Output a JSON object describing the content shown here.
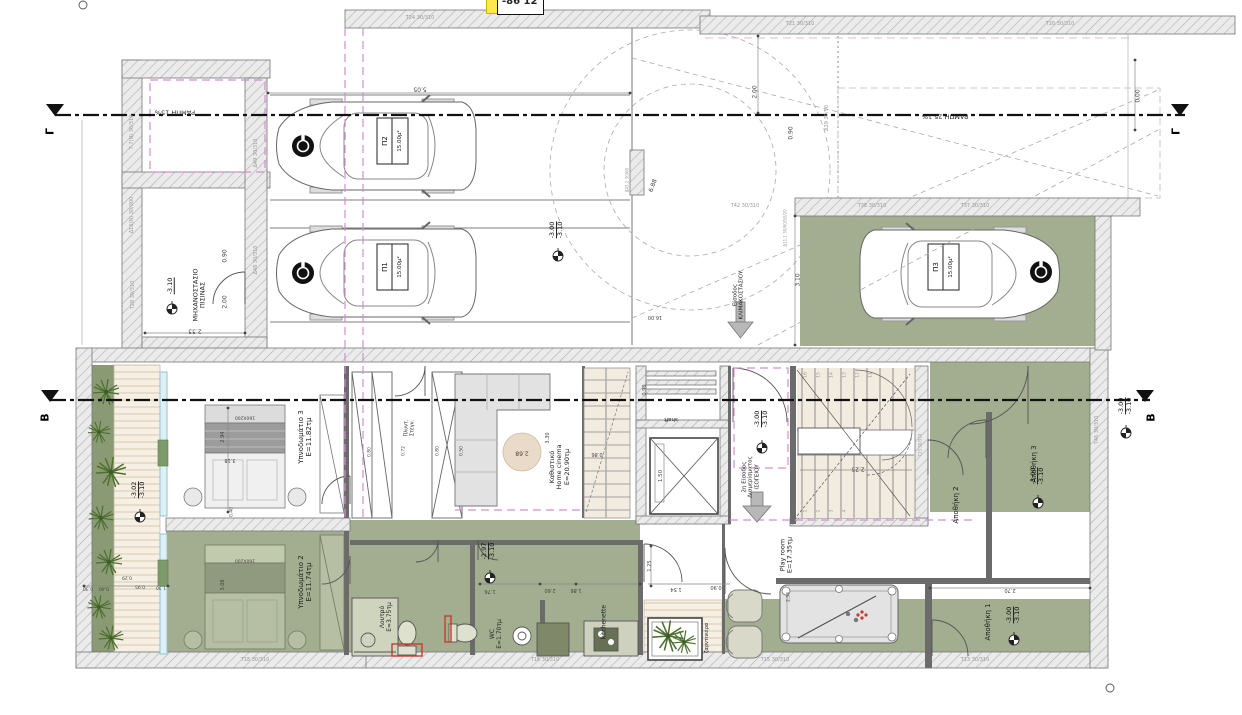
{
  "corner_tag": {
    "text": "-86 12"
  },
  "colors": {
    "zone_green": "#a3ad90",
    "planter_green": "#8a9a74",
    "magenta_dash": "#cf8fcf",
    "stair_beige": "#f2ebe0",
    "highlight_yellow": "#ffe84d",
    "alert_red": "#c53c2e"
  },
  "section_markers": [
    {
      "text": "Γ",
      "x": 51,
      "y": 131
    },
    {
      "text": "Γ",
      "x": 1177,
      "y": 131
    },
    {
      "text": "B",
      "x": 46,
      "y": 417
    },
    {
      "text": "B",
      "x": 1152,
      "y": 417
    }
  ],
  "ramp_labels": [
    {
      "text": "ΡΑΜΠΗ 15%",
      "x": 175,
      "y": 112
    },
    {
      "text": "ΡΑΜΠΗ 25.1%",
      "x": 945,
      "y": 116
    }
  ],
  "rooms": [
    {
      "n": "room-label-pool-plant-room",
      "lines": [
        "ΜΗΧΑΝΟΣΤΑΣΙΟ",
        "ΠΙΣΙΝΑΣ"
      ],
      "x": 200,
      "y": 295,
      "size": 6.5
    },
    {
      "n": "room-label-bedroom-3",
      "lines": [
        "Υπνοδωμάτιο 3",
        "E=11.82τμ"
      ],
      "x": 305,
      "y": 437
    },
    {
      "n": "room-label-bedroom-2",
      "lines": [
        "Υπνοδωμάτιο 2",
        "E=11.74τμ"
      ],
      "x": 305,
      "y": 582
    },
    {
      "n": "room-label-living",
      "lines": [
        "Καθιστικό",
        "Home cinema",
        "E=20.90τμ"
      ],
      "x": 560,
      "y": 467,
      "size": 6.5
    },
    {
      "n": "room-label-bath",
      "lines": [
        "Λουτρό",
        "E=3.75τμ"
      ],
      "x": 387,
      "y": 617,
      "size": 6
    },
    {
      "n": "room-label-wc",
      "lines": [
        "WC",
        "E=1.70τμ"
      ],
      "x": 497,
      "y": 634,
      "size": 6
    },
    {
      "n": "room-label-kitchenette",
      "lines": [
        "kitchenette"
      ],
      "x": 605,
      "y": 622,
      "size": 6
    },
    {
      "n": "room-label-playroom",
      "lines": [
        "Play room",
        "E=17.35τμ"
      ],
      "x": 787,
      "y": 555,
      "size": 6.5
    },
    {
      "n": "room-label-storage-2",
      "lines": [
        "Αποθήκη 2"
      ],
      "x": 956,
      "y": 505
    },
    {
      "n": "room-label-storage-3",
      "lines": [
        "Αποθήκη 3"
      ],
      "x": 1034,
      "y": 464
    },
    {
      "n": "room-label-storage-1",
      "lines": [
        "Αποθήκη 1"
      ],
      "x": 988,
      "y": 622
    },
    {
      "n": "room-label-2nd-entrance",
      "lines": [
        "2η Είσοδος",
        "Διαμερίσματος",
        "ΙΣΟΓΕΙΟΥ"
      ],
      "x": 751,
      "y": 477,
      "size": 5.5
    },
    {
      "n": "room-label-shaft",
      "lines": [
        "shaft"
      ],
      "x": 671,
      "y": 419,
      "rot": 180,
      "size": 5.5
    },
    {
      "n": "room-label-planter",
      "lines": [
        "ζαρντινιέρα"
      ],
      "x": 708,
      "y": 638,
      "size": 5
    },
    {
      "n": "room-label-laundry",
      "lines": [
        "Πλυντ.",
        "Στεγν."
      ],
      "x": 410,
      "y": 428,
      "size": 5
    },
    {
      "n": "room-label-stair-entrance",
      "lines": [
        "Είσοδος",
        "ΚΛΙΜΑΚΟΣΤΑΣΙΟΥ"
      ],
      "x": 739,
      "y": 295,
      "size": 5.5
    }
  ],
  "parking": [
    {
      "n": "parking-space-p2",
      "id": "Π2",
      "area": "15.00μ²",
      "idx": 385,
      "idy": 141,
      "arx": 400,
      "ary": 141
    },
    {
      "n": "parking-space-p1",
      "id": "Π1",
      "area": "15.00μ²",
      "idx": 385,
      "idy": 267,
      "arx": 400,
      "ary": 267
    },
    {
      "n": "parking-space-p3",
      "id": "Π3",
      "area": "15.00μ²",
      "idx": 936,
      "idy": 267,
      "arx": 951,
      "ary": 267
    }
  ],
  "levels": [
    {
      "n": "level-mech-room",
      "top": "-3.10",
      "x": 171,
      "y": 286,
      "single": true
    },
    {
      "n": "level-garage",
      "top": "-3.00",
      "bottom": "-3.10",
      "x": 557,
      "y": 230
    },
    {
      "n": "level-entry-hall",
      "top": "-3.00",
      "bottom": "-3.10",
      "x": 762,
      "y": 419
    },
    {
      "n": "level-storage-3",
      "top": "-3.00",
      "bottom": "-3.10",
      "x": 1038,
      "y": 476
    },
    {
      "n": "level-storage-1",
      "top": "-3.00",
      "bottom": "-3.10",
      "x": 1014,
      "y": 615
    },
    {
      "n": "level-deck",
      "top": "-3.02",
      "bottom": "-3.10",
      "x": 139,
      "y": 490
    },
    {
      "n": "level-bath-zone",
      "top": "-2.97",
      "bottom": "-3.10",
      "x": 489,
      "y": 551
    },
    {
      "n": "level-right-boundary",
      "top": "-3.00",
      "bottom": "-3.10",
      "x": 1126,
      "y": 406
    }
  ],
  "dimensions": [
    {
      "text": "5.05",
      "x": 420,
      "y": 88,
      "rot": 180
    },
    {
      "text": "2.00",
      "x": 756,
      "y": 92,
      "rot": -90
    },
    {
      "text": "0.00",
      "x": 1139,
      "y": 96,
      "rot": -90
    },
    {
      "text": "3.10",
      "x": 799,
      "y": 280,
      "rot": -90
    },
    {
      "text": "0.90",
      "x": 792,
      "y": 133,
      "rot": -90
    },
    {
      "text": "6.88",
      "x": 654,
      "y": 186,
      "rot": -70
    },
    {
      "text": "16.00",
      "x": 655,
      "y": 316,
      "rot": 180,
      "size": 5
    },
    {
      "text": "2.33",
      "x": 195,
      "y": 330,
      "rot": 180
    },
    {
      "text": "2.00",
      "x": 226,
      "y": 302,
      "rot": -90
    },
    {
      "text": "0.90",
      "x": 226,
      "y": 256,
      "rot": -90
    },
    {
      "text": "2.94",
      "x": 224,
      "y": 437,
      "rot": -90,
      "size": 5
    },
    {
      "text": "3.18",
      "x": 230,
      "y": 459,
      "rot": 180,
      "size": 5
    },
    {
      "text": "160X200",
      "x": 245,
      "y": 417,
      "rot": 180,
      "size": 4.5
    },
    {
      "text": "160X200",
      "x": 245,
      "y": 560,
      "rot": 180,
      "size": 4.5
    },
    {
      "text": "3.08",
      "x": 224,
      "y": 585,
      "rot": -90,
      "size": 5
    },
    {
      "text": "0.40",
      "x": 232,
      "y": 512,
      "rot": -90,
      "size": 4.5
    },
    {
      "text": "2.68",
      "x": 522,
      "y": 452,
      "rot": 180
    },
    {
      "text": "3.30",
      "x": 549,
      "y": 438,
      "rot": -90,
      "size": 5
    },
    {
      "text": "0.86",
      "x": 597,
      "y": 453,
      "rot": 180,
      "size": 5
    },
    {
      "text": "0.90",
      "x": 646,
      "y": 390,
      "rot": -90,
      "size": 5
    },
    {
      "text": "1.50",
      "x": 661,
      "y": 476,
      "rot": -90,
      "size": 5.5
    },
    {
      "text": "2.25",
      "x": 858,
      "y": 468,
      "rot": 180
    },
    {
      "text": "2.70",
      "x": 1010,
      "y": 589,
      "rot": 180,
      "size": 5
    },
    {
      "text": "1.76",
      "x": 490,
      "y": 590,
      "rot": 180,
      "size": 5
    },
    {
      "text": "2.60",
      "x": 550,
      "y": 589,
      "rot": 180,
      "size": 5
    },
    {
      "text": "1.86",
      "x": 576,
      "y": 589,
      "rot": 180,
      "size": 5
    },
    {
      "text": "1.54",
      "x": 676,
      "y": 588,
      "rot": 180,
      "size": 5
    },
    {
      "text": "1.25",
      "x": 651,
      "y": 566,
      "rot": -90,
      "size": 5
    },
    {
      "text": "0.90",
      "x": 716,
      "y": 586,
      "rot": 180,
      "size": 5
    },
    {
      "text": "0.30",
      "x": 88,
      "y": 588,
      "rot": 180,
      "size": 4.5
    },
    {
      "text": "0.40",
      "x": 104,
      "y": 588,
      "rot": 180,
      "size": 4.5
    },
    {
      "text": "0.29",
      "x": 127,
      "y": 577,
      "rot": 180,
      "size": 4.5
    },
    {
      "text": "0.95",
      "x": 140,
      "y": 586,
      "rot": 180,
      "size": 4.5
    },
    {
      "text": "1.30",
      "x": 161,
      "y": 587,
      "rot": 180,
      "size": 4.5
    },
    {
      "text": "0.80",
      "x": 370,
      "y": 452,
      "rot": -90,
      "size": 4.5
    },
    {
      "text": "0.72",
      "x": 404,
      "y": 451,
      "rot": -90,
      "size": 4.5
    },
    {
      "text": "0.80",
      "x": 438,
      "y": 451,
      "rot": -90,
      "size": 4.5
    },
    {
      "text": "0.50",
      "x": 462,
      "y": 451,
      "rot": -90,
      "size": 4.5
    },
    {
      "text": "2.54",
      "x": 789,
      "y": 597,
      "rot": -90,
      "size": 4.5
    }
  ],
  "wall_tags": [
    {
      "text": "Τ.7(Ν) 30/310",
      "x": 133,
      "y": 132
    },
    {
      "text": "Δ16(Ν) 30/300",
      "x": 133,
      "y": 215
    },
    {
      "text": "Τ28 30/310",
      "x": 134,
      "y": 295
    },
    {
      "text": "Δ49 30/310",
      "x": 257,
      "y": 153
    },
    {
      "text": "Δ48 30/310",
      "x": 257,
      "y": 260
    },
    {
      "text": "Τ24 30/310",
      "x": 420,
      "y": 19,
      "rot": 0
    },
    {
      "text": "Τ21 30/310",
      "x": 800,
      "y": 25,
      "rot": 0
    },
    {
      "text": "Τ20 30/310",
      "x": 1060,
      "y": 25,
      "rot": 0
    },
    {
      "text": "Τ42 30/310",
      "x": 745,
      "y": 207,
      "rot": 0
    },
    {
      "text": "Τ38 30/310",
      "x": 872,
      "y": 207,
      "rot": 0
    },
    {
      "text": "Τ37 30/310",
      "x": 975,
      "y": 207,
      "rot": 0
    },
    {
      "text": "Δ39 30/50",
      "x": 828,
      "y": 118
    },
    {
      "text": "Δ11.1 30/60/50/20",
      "x": 786,
      "y": 228,
      "size": 4
    },
    {
      "text": "Δ43.2 30/60",
      "x": 628,
      "y": 180,
      "size": 4
    },
    {
      "text": "Τ46 30/310",
      "x": 1098,
      "y": 430
    },
    {
      "text": "Τ23 30/310",
      "x": 921,
      "y": 445,
      "size": 4
    },
    {
      "text": "Τ18 30/310",
      "x": 255,
      "y": 661,
      "rot": 0
    },
    {
      "text": "Τ16 30/310",
      "x": 545,
      "y": 661,
      "rot": 0
    },
    {
      "text": "Τ15 30/310",
      "x": 775,
      "y": 661,
      "rot": 0
    },
    {
      "text": "Τ13 30/310",
      "x": 975,
      "y": 661,
      "rot": 0
    }
  ],
  "stair_numbers": [
    {
      "text": "16",
      "x": 806,
      "y": 375
    },
    {
      "text": "15",
      "x": 819,
      "y": 375
    },
    {
      "text": "14",
      "x": 832,
      "y": 375
    },
    {
      "text": "13",
      "x": 845,
      "y": 375
    },
    {
      "text": "12",
      "x": 858,
      "y": 375
    },
    {
      "text": "11",
      "x": 871,
      "y": 375
    },
    {
      "text": "1",
      "x": 806,
      "y": 511
    },
    {
      "text": "2",
      "x": 819,
      "y": 511
    },
    {
      "text": "3",
      "x": 832,
      "y": 511
    },
    {
      "text": "4",
      "x": 845,
      "y": 511
    }
  ]
}
